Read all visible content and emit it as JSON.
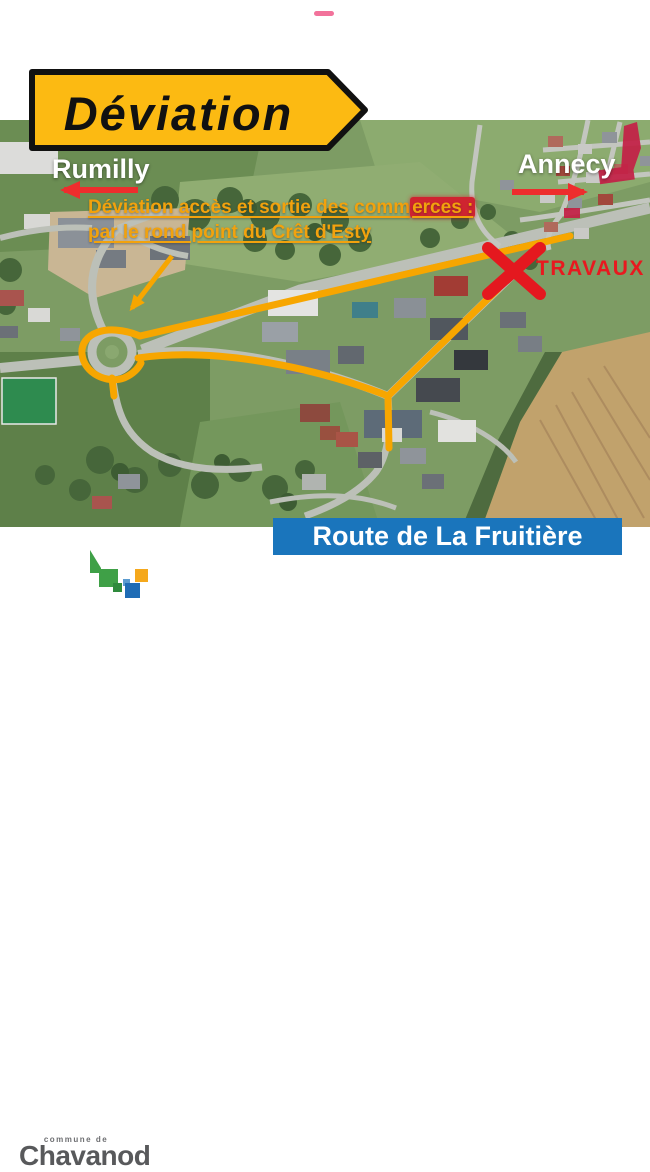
{
  "decor": {
    "top_dash_color": "#f2729b"
  },
  "sign": {
    "label": "Déviation",
    "bg_color": "#fcba12",
    "border_color": "#111111"
  },
  "map": {
    "city_left": "Rumilly",
    "city_right": "Annecy",
    "annotation_line1_plain": "Déviation accès et sortie des comm",
    "annotation_line1_highlight": "erces :",
    "annotation_line2": "par le rond point du Crêt d'Esty",
    "annotation_color": "#f2a20d",
    "works_label": "TRAVAUX",
    "works_color": "#e8191f",
    "route_color": "#f7a600",
    "arrow_color": "#ee2d2d",
    "highlight_color": "#c42046"
  },
  "banner": {
    "label": "Route de La Fruitière",
    "bg_color": "#1a75bc",
    "text_color": "#ffffff"
  },
  "logo": {
    "upper_label": "commune de",
    "name": "Chavanod",
    "green": "#3fa047",
    "blue": "#1f6cb5",
    "yellow": "#f5a81c",
    "text_color": "#58595b"
  }
}
